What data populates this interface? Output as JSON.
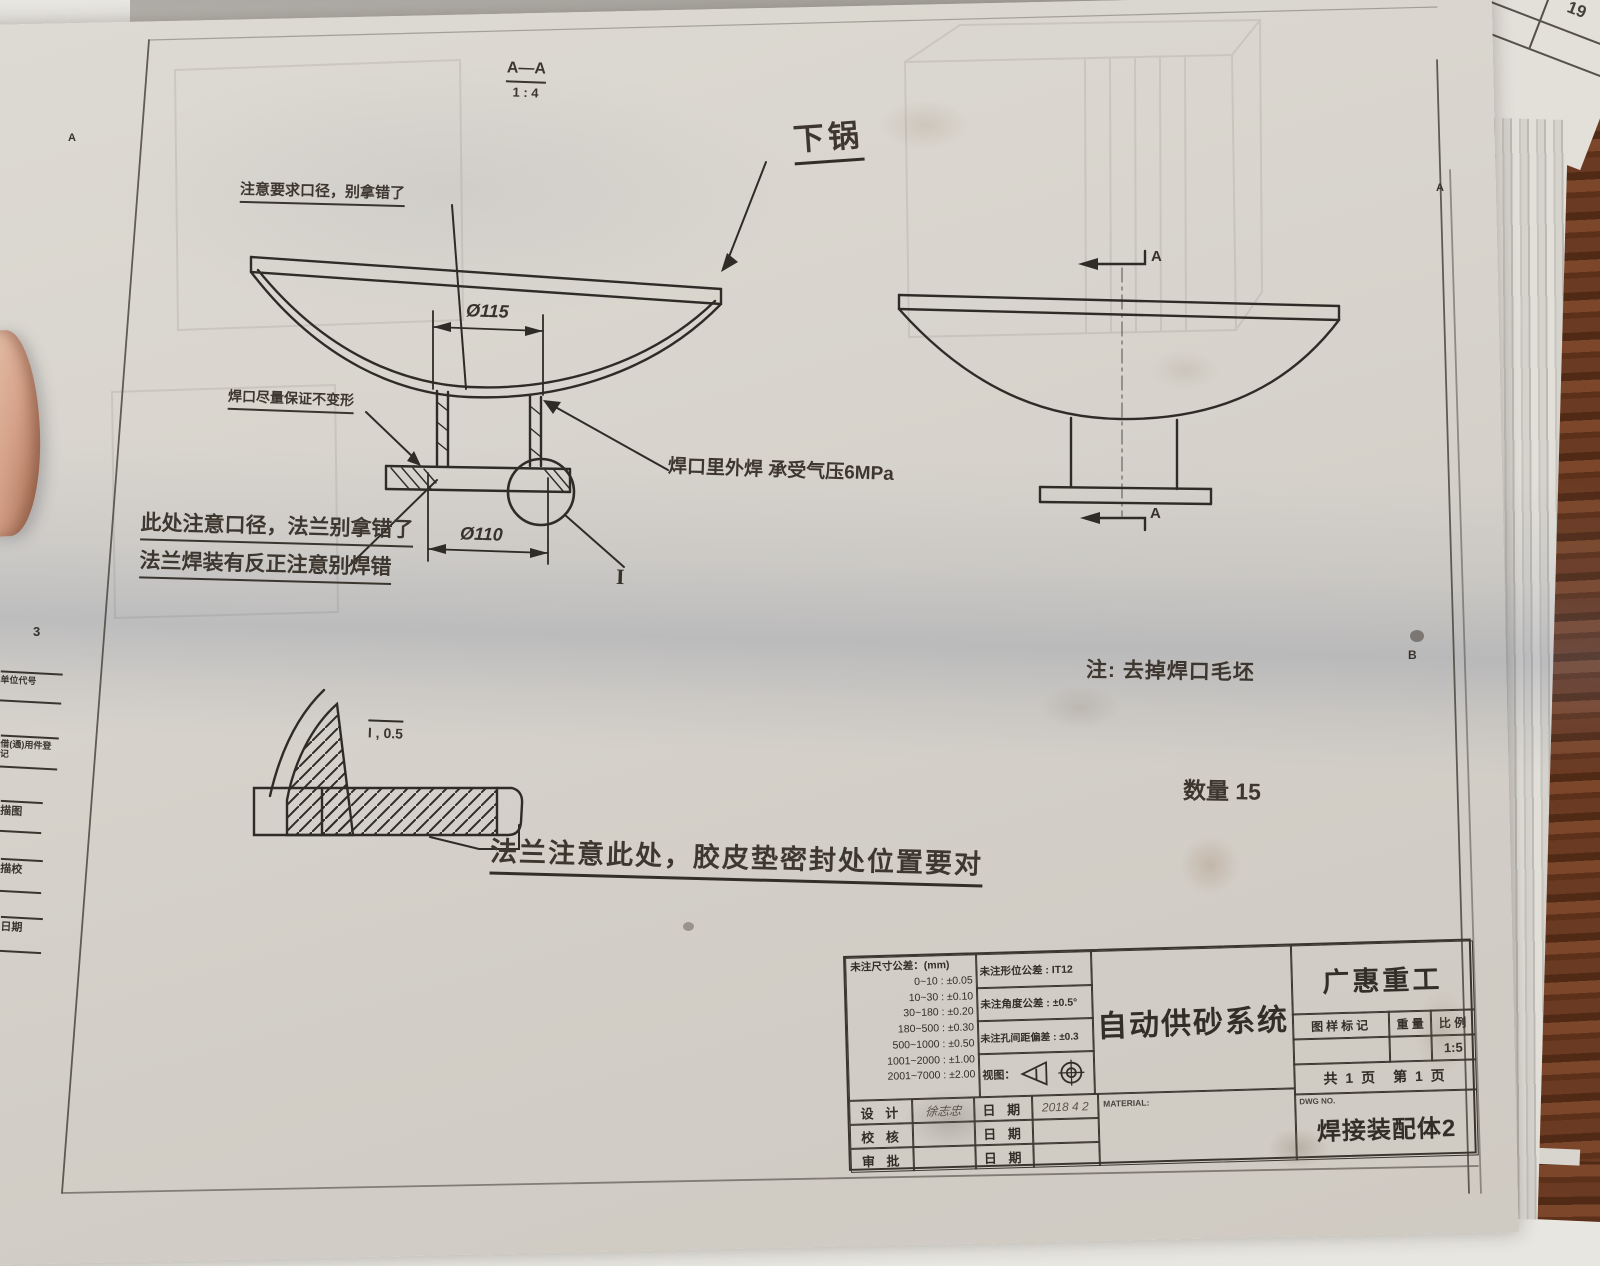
{
  "colors": {
    "ink": "#2f2b26",
    "paper": "#d8d4cd",
    "wood": "#5a3321"
  },
  "frame": {
    "zone_number": "3",
    "zone_letter_left": "A",
    "zone_letter_right_top": "A",
    "zone_letter_right_mid": "B",
    "left_rows": [
      "单位代号",
      "借(通)用件登记",
      "描图",
      "描校",
      "日期"
    ],
    "underlay_number": "19"
  },
  "section": {
    "label": "A—A",
    "scale": "1 : 4"
  },
  "drawing": {
    "part_label": "下锅",
    "dim_neck_top": "Ø115",
    "dim_neck_bottom": "Ø110",
    "detail_ref": "I",
    "detail_scale_label": "I , 0.5",
    "section_arrow_top": "A",
    "section_arrow_bottom": "A"
  },
  "annotations": {
    "note_top": "注意要求口径，别拿错了",
    "note_weld_shape": "焊口尽量保证不变形",
    "note_flange_1": "此处注意口径，法兰别拿错了",
    "note_flange_2": "法兰焊装有反正注意别焊错",
    "note_pressure": "焊口里外焊 承受气压6MPa",
    "note_deburr": "注: 去掉焊口毛坯",
    "quantity": "数量 15",
    "note_gasket": "法兰注意此处，胶皮垫密封处位置要对"
  },
  "title_block": {
    "tol_header": "未注尺寸公差：(mm)",
    "tol_rows": [
      "0~10 : ±0.05",
      "10~30 : ±0.10",
      "30~180 : ±0.20",
      "180~500 : ±0.30",
      "500~1000 : ±0.50",
      "1001~2000 : ±1.00",
      "2001~7000 : ±2.00"
    ],
    "geo_tol": "未注形位公差 : IT12",
    "angle_tol": "未注角度公差 : ±0.5°",
    "hole_tol": "未注孔间距偏差 : ±0.3",
    "view_label": "视图：",
    "design_label": "设 计",
    "check_label": "校 核",
    "approve_label": "审 批",
    "date_label": "日 期",
    "designer_name": "徐志忠",
    "design_date": "2018 4 2",
    "material_label": "MATERIAL:",
    "title": "自动供砂系统",
    "company": "广惠重工",
    "mark_label": "图样标记",
    "weight_label": "重 量",
    "scale_label": "比 例",
    "scale_value": "1:5",
    "pages": "共 1 页　第 1 页",
    "dwg_no_label": "DWG NO.",
    "drawing_name": "焊接装配体2"
  }
}
